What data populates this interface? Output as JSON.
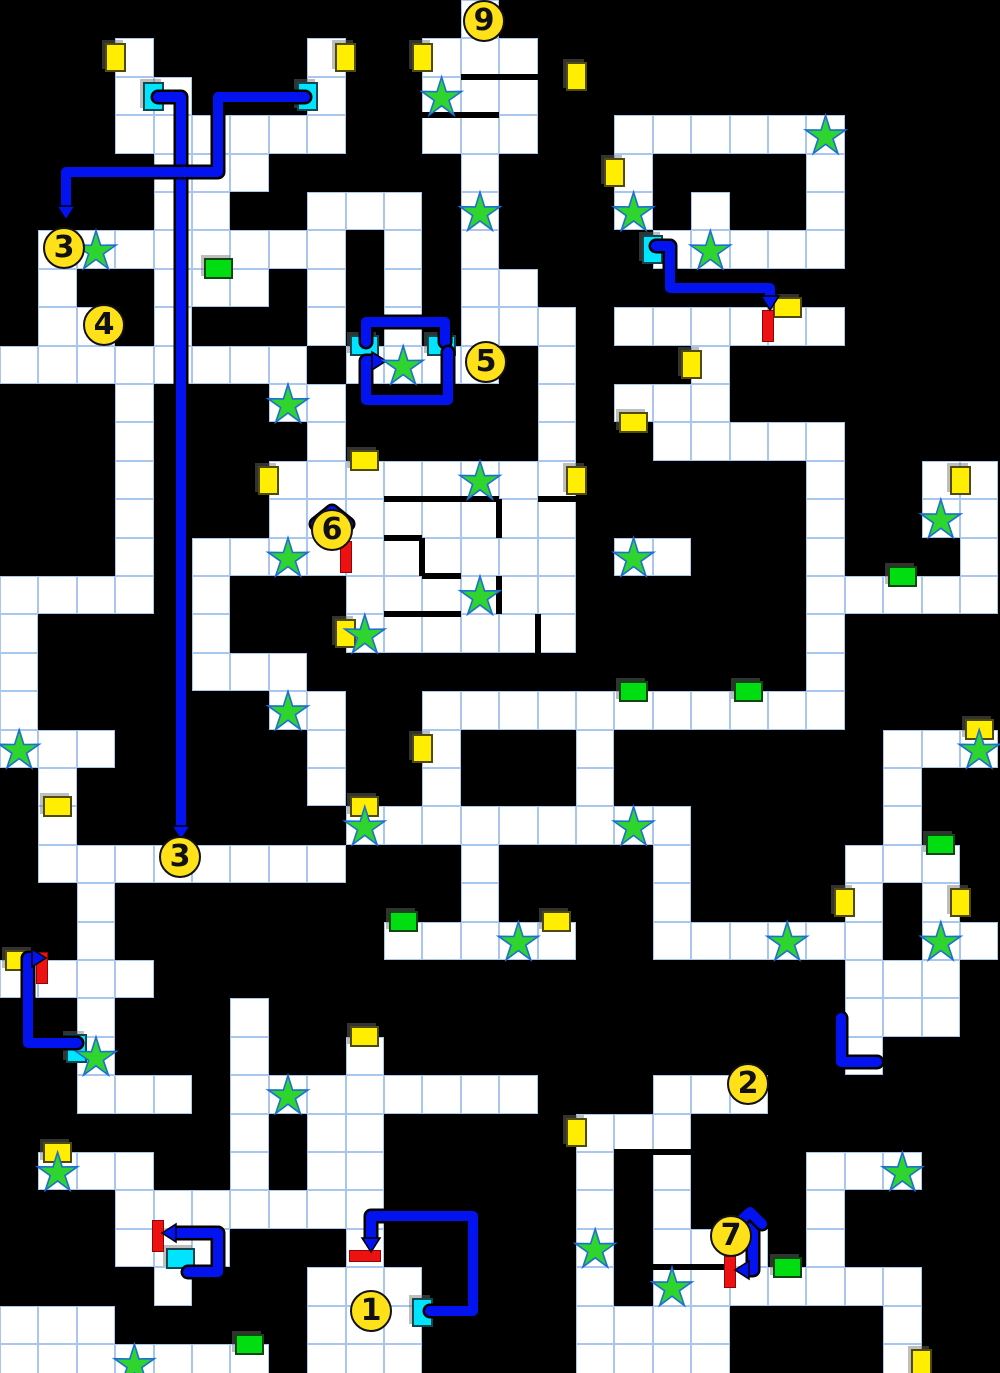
{
  "map": {
    "cols": 26,
    "rows": 36,
    "cell": 38.4,
    "colors": {
      "background": "#000000",
      "floor": "#ffffff",
      "grid": "#a9c6ee",
      "door_yellow": "#ffee00",
      "door_cyan": "#00e4ff",
      "door_green": "#00dd11",
      "lock_bar_red": "#ee1111",
      "stairs_fill": "#ffe11a",
      "star_fill": "#2fd42f",
      "star_stroke": "#1d6fd2",
      "path_blue": "#0313ef"
    },
    "floor_rows": [
      [
        [
          12,
          12
        ]
      ],
      [
        [
          3,
          3
        ],
        [
          8,
          8
        ],
        [
          11,
          13
        ]
      ],
      [
        [
          3,
          4
        ],
        [
          8,
          8
        ],
        [
          11,
          13
        ]
      ],
      [
        [
          3,
          8
        ],
        [
          11,
          13
        ],
        [
          16,
          21
        ]
      ],
      [
        [
          4,
          6
        ],
        [
          12,
          12
        ],
        [
          16,
          16
        ],
        [
          21,
          21
        ]
      ],
      [
        [
          4,
          5
        ],
        [
          8,
          10
        ],
        [
          12,
          12
        ],
        [
          16,
          16
        ],
        [
          18,
          18
        ],
        [
          21,
          21
        ]
      ],
      [
        [
          1,
          8
        ],
        [
          10,
          10
        ],
        [
          12,
          12
        ],
        [
          17,
          21
        ]
      ],
      [
        [
          1,
          1
        ],
        [
          4,
          6
        ],
        [
          8,
          8
        ],
        [
          10,
          10
        ],
        [
          12,
          13
        ]
      ],
      [
        [
          1,
          2
        ],
        [
          4,
          4
        ],
        [
          8,
          8
        ],
        [
          10,
          10
        ],
        [
          12,
          14
        ],
        [
          16,
          21
        ]
      ],
      [
        [
          0,
          7
        ],
        [
          9,
          12
        ],
        [
          14,
          14
        ],
        [
          18,
          18
        ]
      ],
      [
        [
          3,
          3
        ],
        [
          7,
          8
        ],
        [
          14,
          14
        ],
        [
          16,
          18
        ]
      ],
      [
        [
          3,
          3
        ],
        [
          8,
          8
        ],
        [
          14,
          14
        ],
        [
          17,
          21
        ]
      ],
      [
        [
          3,
          3
        ],
        [
          7,
          14
        ],
        [
          21,
          21
        ],
        [
          24,
          25
        ]
      ],
      [
        [
          3,
          3
        ],
        [
          7,
          14
        ],
        [
          21,
          21
        ],
        [
          24,
          25
        ]
      ],
      [
        [
          3,
          3
        ],
        [
          5,
          14
        ],
        [
          16,
          17
        ],
        [
          21,
          21
        ],
        [
          25,
          25
        ]
      ],
      [
        [
          0,
          3
        ],
        [
          5,
          5
        ],
        [
          9,
          14
        ],
        [
          21,
          25
        ]
      ],
      [
        [
          0,
          0
        ],
        [
          5,
          5
        ],
        [
          9,
          14
        ],
        [
          21,
          21
        ]
      ],
      [
        [
          0,
          0
        ],
        [
          5,
          7
        ],
        [
          21,
          21
        ]
      ],
      [
        [
          0,
          0
        ],
        [
          7,
          8
        ],
        [
          11,
          21
        ]
      ],
      [
        [
          0,
          2
        ],
        [
          8,
          8
        ],
        [
          11,
          11
        ],
        [
          15,
          15
        ],
        [
          23,
          25
        ]
      ],
      [
        [
          1,
          1
        ],
        [
          8,
          8
        ],
        [
          11,
          11
        ],
        [
          15,
          15
        ],
        [
          23,
          23
        ]
      ],
      [
        [
          1,
          1
        ],
        [
          9,
          17
        ],
        [
          23,
          23
        ]
      ],
      [
        [
          1,
          8
        ],
        [
          12,
          12
        ],
        [
          17,
          17
        ],
        [
          22,
          24
        ]
      ],
      [
        [
          2,
          2
        ],
        [
          12,
          12
        ],
        [
          17,
          17
        ],
        [
          22,
          22
        ],
        [
          24,
          24
        ]
      ],
      [
        [
          2,
          2
        ],
        [
          10,
          14
        ],
        [
          17,
          22
        ],
        [
          24,
          25
        ]
      ],
      [
        [
          0,
          3
        ],
        [
          22,
          24
        ]
      ],
      [
        [
          2,
          2
        ],
        [
          6,
          6
        ],
        [
          22,
          24
        ]
      ],
      [
        [
          2,
          2
        ],
        [
          6,
          6
        ],
        [
          9,
          9
        ],
        [
          22,
          22
        ]
      ],
      [
        [
          2,
          4
        ],
        [
          6,
          13
        ],
        [
          17,
          19
        ]
      ],
      [
        [
          6,
          6
        ],
        [
          8,
          9
        ],
        [
          15,
          17
        ]
      ],
      [
        [
          1,
          3
        ],
        [
          6,
          6
        ],
        [
          8,
          9
        ],
        [
          15,
          15
        ],
        [
          17,
          17
        ],
        [
          21,
          23
        ]
      ],
      [
        [
          3,
          9
        ],
        [
          15,
          15
        ],
        [
          17,
          17
        ],
        [
          21,
          21
        ]
      ],
      [
        [
          3,
          5
        ],
        [
          9,
          9
        ],
        [
          15,
          15
        ],
        [
          17,
          19
        ],
        [
          21,
          21
        ]
      ],
      [
        [
          4,
          4
        ],
        [
          8,
          10
        ],
        [
          15,
          15
        ],
        [
          17,
          23
        ]
      ],
      [
        [
          0,
          2
        ],
        [
          8,
          10
        ],
        [
          15,
          18
        ],
        [
          23,
          23
        ]
      ],
      [
        [
          0,
          6
        ],
        [
          8,
          10
        ],
        [
          15,
          18
        ],
        [
          23,
          23
        ]
      ]
    ],
    "walls": [
      [
        460.8,
        76.8,
        537.6,
        76.8
      ],
      [
        422.4,
        115.2,
        499.2,
        115.2
      ],
      [
        384,
        499.2,
        499.2,
        499.2
      ],
      [
        537.6,
        499.2,
        576,
        499.2
      ],
      [
        384,
        537.6,
        422.4,
        537.6
      ],
      [
        422.4,
        576,
        460.8,
        576
      ],
      [
        384,
        614.4,
        460.8,
        614.4
      ],
      [
        614.4,
        1152,
        691.2,
        1152
      ],
      [
        652.8,
        1267.2,
        729.6,
        1267.2
      ],
      [
        499.2,
        499.2,
        499.2,
        537.6
      ],
      [
        422.4,
        537.6,
        422.4,
        576
      ],
      [
        499.2,
        576,
        499.2,
        614.4
      ],
      [
        537.6,
        614.4,
        537.6,
        652.8
      ]
    ],
    "doors": [
      {
        "k": "y",
        "o": "v",
        "x": 115.2,
        "y": 57.6
      },
      {
        "k": "y",
        "o": "v",
        "x": 345.6,
        "y": 57.6
      },
      {
        "k": "y",
        "o": "v",
        "x": 422.4,
        "y": 57.6
      },
      {
        "k": "y",
        "o": "v",
        "x": 576,
        "y": 76.8
      },
      {
        "k": "y",
        "o": "v",
        "x": 614.4,
        "y": 172.8
      },
      {
        "k": "y",
        "o": "v",
        "x": 691.2,
        "y": 364.8
      },
      {
        "k": "y",
        "o": "v",
        "x": 268.8,
        "y": 480
      },
      {
        "k": "y",
        "o": "v",
        "x": 576,
        "y": 480
      },
      {
        "k": "y",
        "o": "v",
        "x": 960,
        "y": 480
      },
      {
        "k": "y",
        "o": "v",
        "x": 345.6,
        "y": 633.6
      },
      {
        "k": "y",
        "o": "v",
        "x": 422.4,
        "y": 748.8
      },
      {
        "k": "y",
        "o": "v",
        "x": 844.8,
        "y": 902.4
      },
      {
        "k": "y",
        "o": "v",
        "x": 960,
        "y": 902.4
      },
      {
        "k": "y",
        "o": "v",
        "x": 576,
        "y": 1132.8
      },
      {
        "k": "y",
        "o": "v",
        "x": 921.6,
        "y": 1363.2
      },
      {
        "k": "y",
        "o": "h",
        "x": 787.2,
        "y": 307.2
      },
      {
        "k": "y",
        "o": "h",
        "x": 633.6,
        "y": 422.4
      },
      {
        "k": "y",
        "o": "h",
        "x": 364.8,
        "y": 460.8
      },
      {
        "k": "y",
        "o": "h",
        "x": 979.2,
        "y": 729.6
      },
      {
        "k": "y",
        "o": "h",
        "x": 57.6,
        "y": 806.4
      },
      {
        "k": "y",
        "o": "h",
        "x": 364.8,
        "y": 806.4
      },
      {
        "k": "y",
        "o": "h",
        "x": 556.8,
        "y": 921.6
      },
      {
        "k": "y",
        "o": "h",
        "x": 19.2,
        "y": 960
      },
      {
        "k": "y",
        "o": "h",
        "x": 364.8,
        "y": 1036.8
      },
      {
        "k": "y",
        "o": "h",
        "x": 57.6,
        "y": 1152
      },
      {
        "k": "c",
        "o": "v",
        "x": 153.6,
        "y": 96
      },
      {
        "k": "c",
        "o": "v",
        "x": 307.2,
        "y": 96
      },
      {
        "k": "c",
        "o": "v",
        "x": 652.8,
        "y": 249.6
      },
      {
        "k": "c",
        "o": "v",
        "x": 76.8,
        "y": 1048
      },
      {
        "k": "c",
        "o": "v",
        "x": 422.4,
        "y": 1312
      },
      {
        "k": "c",
        "o": "h",
        "x": 364.8,
        "y": 345.6
      },
      {
        "k": "c",
        "o": "h",
        "x": 441.6,
        "y": 345.6
      },
      {
        "k": "c",
        "o": "h",
        "x": 180,
        "y": 1258
      },
      {
        "k": "g",
        "o": "h",
        "x": 218,
        "y": 268.8
      },
      {
        "k": "g",
        "o": "h",
        "x": 902.4,
        "y": 576
      },
      {
        "k": "g",
        "o": "h",
        "x": 633.6,
        "y": 691.2
      },
      {
        "k": "g",
        "o": "h",
        "x": 748.8,
        "y": 691.2
      },
      {
        "k": "g",
        "o": "h",
        "x": 940.8,
        "y": 844.8
      },
      {
        "k": "g",
        "o": "h",
        "x": 403.2,
        "y": 921.6
      },
      {
        "k": "g",
        "o": "h",
        "x": 787.2,
        "y": 1267.2
      },
      {
        "k": "g",
        "o": "h",
        "x": 249.6,
        "y": 1344
      }
    ],
    "bars": [
      {
        "o": "v",
        "x": 768,
        "y": 326.4
      },
      {
        "o": "v",
        "x": 345.6,
        "y": 556.8
      },
      {
        "o": "v",
        "x": 42,
        "y": 968
      },
      {
        "o": "v",
        "x": 158,
        "y": 1236
      },
      {
        "o": "v",
        "x": 729.6,
        "y": 1272
      },
      {
        "o": "h",
        "x": 364.8,
        "y": 1256
      }
    ],
    "stars": [
      [
        11,
        2
      ],
      [
        21,
        3
      ],
      [
        12,
        5
      ],
      [
        16,
        5
      ],
      [
        2,
        6
      ],
      [
        18,
        6
      ],
      [
        10,
        9
      ],
      [
        7,
        10
      ],
      [
        12,
        12
      ],
      [
        24,
        13
      ],
      [
        7,
        14
      ],
      [
        16,
        14
      ],
      [
        12,
        15
      ],
      [
        9,
        16
      ],
      [
        7,
        18
      ],
      [
        0,
        19
      ],
      [
        25,
        19
      ],
      [
        9,
        21
      ],
      [
        16,
        21
      ],
      [
        13,
        24
      ],
      [
        20,
        24
      ],
      [
        24,
        24
      ],
      [
        2,
        27
      ],
      [
        7,
        28
      ],
      [
        1,
        30
      ],
      [
        23,
        30
      ],
      [
        15,
        32
      ],
      [
        17,
        33
      ],
      [
        3,
        35
      ]
    ],
    "stairs": [
      {
        "n": "9",
        "x": 484,
        "y": 21
      },
      {
        "n": "3",
        "x": 64,
        "y": 248
      },
      {
        "n": "4",
        "x": 104,
        "y": 325
      },
      {
        "n": "5",
        "x": 486,
        "y": 362
      },
      {
        "n": "6",
        "x": 332,
        "y": 530
      },
      {
        "n": "3",
        "x": 180,
        "y": 857
      },
      {
        "n": "2",
        "x": 748,
        "y": 1084
      },
      {
        "n": "7",
        "x": 731,
        "y": 1236
      },
      {
        "n": "1",
        "x": 371,
        "y": 1311
      }
    ],
    "paths": [
      {
        "pts": [
          [
            158,
            97
          ],
          [
            181,
            97
          ],
          [
            181,
            826
          ]
        ],
        "arrow": "down"
      },
      {
        "pts": [
          [
            305,
            97
          ],
          [
            218,
            97
          ],
          [
            218,
            172
          ],
          [
            66,
            172
          ],
          [
            66,
            206
          ]
        ],
        "arrow": "down"
      },
      {
        "pts": [
          [
            656,
            246
          ],
          [
            670,
            246
          ],
          [
            670,
            288
          ],
          [
            770,
            288
          ],
          [
            770,
            296
          ]
        ],
        "arrow": "down"
      },
      {
        "pts": [
          [
            366,
            342
          ],
          [
            366,
            322
          ],
          [
            445,
            322
          ],
          [
            445,
            342
          ]
        ],
        "arrow": null
      },
      {
        "pts": [
          [
            448,
            352
          ],
          [
            448,
            400
          ],
          [
            366,
            400
          ],
          [
            366,
            361
          ],
          [
            372,
            361
          ]
        ],
        "arrow": "right"
      },
      {
        "pts": [
          [
            316,
            524
          ],
          [
            332,
            511
          ],
          [
            348,
            524
          ]
        ],
        "arrow": null
      },
      {
        "pts": [
          [
            77,
            1043
          ],
          [
            28,
            1043
          ],
          [
            28,
            958
          ],
          [
            32,
            958
          ]
        ],
        "arrow": "right"
      },
      {
        "pts": [
          [
            430,
            1311
          ],
          [
            473,
            1311
          ],
          [
            473,
            1216
          ],
          [
            371,
            1216
          ],
          [
            371,
            1238
          ]
        ],
        "arrow": "down"
      },
      {
        "pts": [
          [
            188,
            1272
          ],
          [
            218,
            1272
          ],
          [
            218,
            1233
          ],
          [
            176,
            1233
          ]
        ],
        "arrow": "left"
      },
      {
        "pts": [
          [
            753,
            1226
          ],
          [
            753,
            1270
          ],
          [
            749,
            1270
          ]
        ],
        "arrow": "left"
      },
      {
        "pts": [
          [
            737,
            1224
          ],
          [
            750,
            1212
          ],
          [
            762,
            1224
          ]
        ],
        "arrow": null
      },
      {
        "pts": [
          [
            841,
            1018
          ],
          [
            841,
            1062
          ],
          [
            877,
            1062
          ]
        ],
        "arrow": null
      }
    ]
  }
}
